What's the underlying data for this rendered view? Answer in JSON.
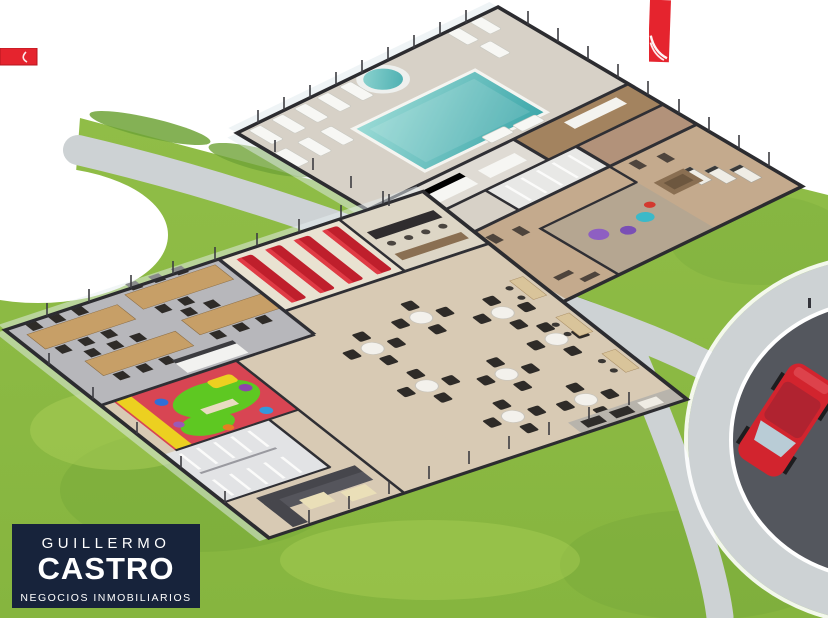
{
  "brand": {
    "first_name": "GUILLERMO",
    "last_name": "CASTRO",
    "tagline": "NEGOCIOS INMOBILIARIOS"
  },
  "scene": {
    "areas": [
      "swimming-pool",
      "jacuzzi",
      "sun-loungers",
      "changing-rooms",
      "gym",
      "stretching-room",
      "coworking-tables",
      "cinema-room",
      "kids-playroom",
      "restrooms",
      "lounge-sofas",
      "dining-hall",
      "bar-counter",
      "bbq-area",
      "walking-paths",
      "roundabout",
      "red-car",
      "grass-lawn"
    ]
  },
  "colors": {
    "background": "#ffffff",
    "brand_navy": "#17233b",
    "brand_red": "#e5242e",
    "grass": "#8cbb44",
    "grass_dark": "#6fa337",
    "grass_light": "#a9ce55",
    "path_gray": "#cdd2d4",
    "asphalt": "#54575e",
    "deck": "#d7d1c7",
    "pool_teal": "#56bcbc",
    "pool_teal_light": "#9fdbd7",
    "wood_floor": "#d8cab4",
    "office_floor": "#b7b7bb",
    "gym_floor": "#c4aa8d",
    "room_brown": "#a3835f",
    "room_brown2": "#b2927a",
    "cinema_red": "#bf1f2c",
    "kids_red": "#d84553",
    "kids_green": "#5ec822",
    "kids_yellow": "#ecd020",
    "table_wood": "#c79f67",
    "chair_dark": "#2e2b28",
    "wall_dark": "#2c2c30",
    "wall_light": "#f1f1ef",
    "car_red": "#d2242e"
  }
}
